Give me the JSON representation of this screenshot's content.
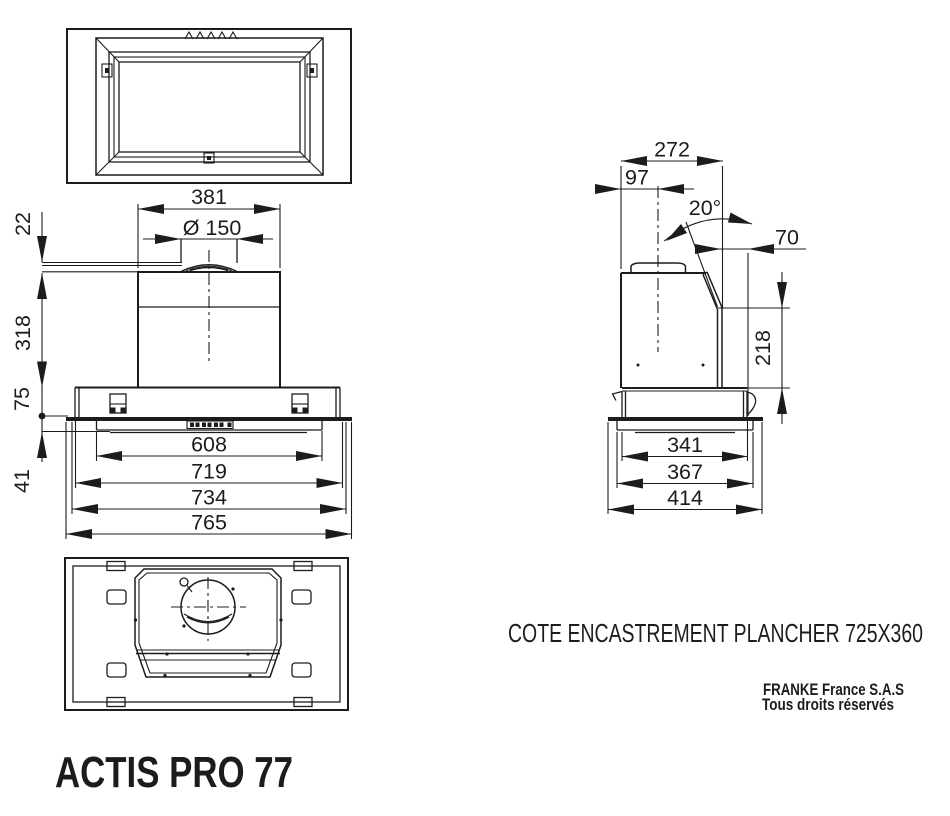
{
  "front_view": {
    "dim_width_top": "381",
    "dim_duct": "Ø 150",
    "dim_flange": "22",
    "dim_body_height": "318",
    "dim_base_height": "75",
    "dim_panel_height": "41",
    "dim_inner_width": "608",
    "dim_base_width": "719",
    "dim_panel_width": "734",
    "dim_overall_width": "765"
  },
  "side_view": {
    "dim_depth_top": "272",
    "dim_duct_offset": "97",
    "dim_angle": "20°",
    "dim_back_offset": "70",
    "dim_body_height": "218",
    "dim_base_depth": "341",
    "dim_panel_depth": "367",
    "dim_overall_depth": "414"
  },
  "footer": {
    "note": "COTE ENCASTREMENT PLANCHER 725X360",
    "company": "FRANKE France S.A.S",
    "rights": "Tous droits réservés",
    "product_name": "ACTIS PRO 77"
  },
  "colors": {
    "line": "#1c1c1c",
    "background": "#ffffff"
  }
}
